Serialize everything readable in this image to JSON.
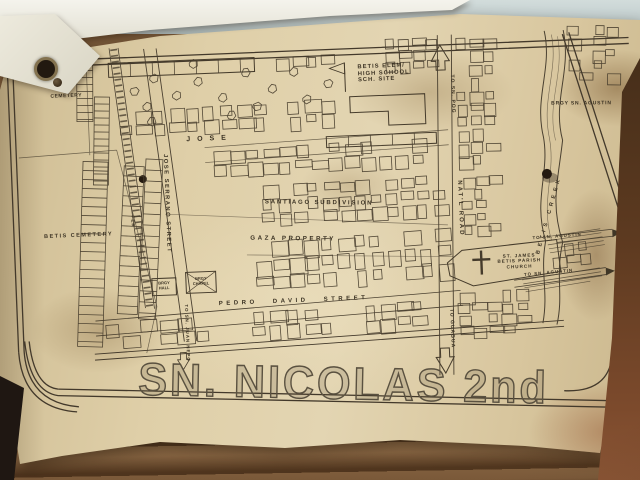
{
  "colors": {
    "paper": "#d9c8a1",
    "ink": "#3b3223",
    "wall_top": "#c3ced0",
    "wood_surface": "#6e4e30"
  },
  "map": {
    "title": "SN. NICOLAS 2nd",
    "labels": {
      "cemetery_top": "CEMETERY",
      "betis_cemetery": "BETIS CEMETERY",
      "jose_block": "JOSE",
      "jose_serrano_street": "JOSE SERRANO STREET",
      "per": "PER",
      "santiago_subdivision": "SANTIAGO SUBDIVISION",
      "gaza_property": "GAZA PROPERTY",
      "pedro_david_street": "PEDRO DAVID STREET",
      "natl_road": "NAT'L ROAD",
      "betis_creek": "BETIS CREEK",
      "brgy_sn_agustin": "BRGY SN. AGUSTIN",
      "to_sn_pog": "TO SN. POG",
      "to_guagua": "TO GUAGUA",
      "to_sn_juan_nepo": "TO SN. JUAN NEPO",
      "to_sn_agustin_upper": "TO SN. AGUSTIN",
      "to_sn_agustin_lower": "TO SN. AGUSTIN",
      "brgy_hall": [
        "BRGY",
        "HALL"
      ],
      "brgy_chapel": [
        "BRGY",
        "CHAPEL"
      ],
      "school_site": [
        "BETIS ELEM/",
        "HIGH SCHOOL",
        "SCH. SITE"
      ],
      "church": [
        "ST. JAMES",
        "BETIS PARISH",
        "CHURCH"
      ]
    }
  }
}
